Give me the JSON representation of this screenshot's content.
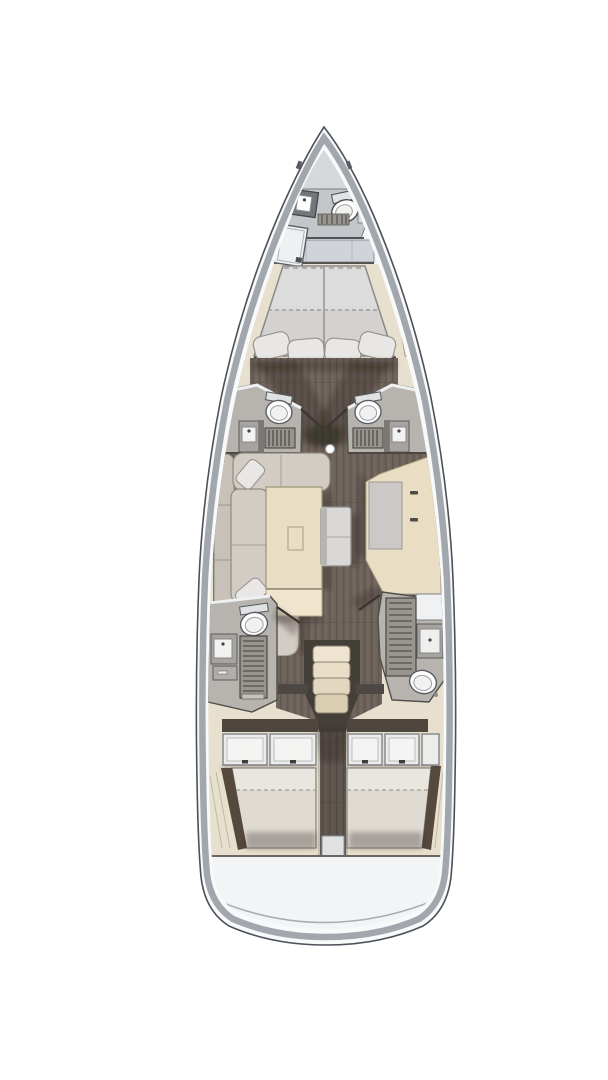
{
  "meta": {
    "type": "sailing-yacht-interior-floor-plan",
    "view": "top-down",
    "orientation": "bow-up",
    "canvas": {
      "width": 608,
      "height": 1080
    }
  },
  "palette": {
    "page_bg": "#ffffff",
    "hull_fill": "#f8f9fa",
    "hull_outline": "#4c5058",
    "hull_band": "#a2a7ae",
    "deck_white": "#f4f5f7",
    "anchor_locker": "#d6d9dc",
    "interior_beige": "#e8e0ce",
    "panel_beige": "#e5dcc8",
    "wood_floor": "#6d635b",
    "wood_line": "#5f564f",
    "head_floor": "#b7b4b0",
    "wall_dark": "#4b4844",
    "wall_white": "#eef0f1",
    "fixture_white": "#fdfdfd",
    "cabinet_gray": "#a6a3a0",
    "grate_gray": "#989591",
    "grate_slat": "#5f5c58",
    "mattress_light": "#dcdcdd",
    "mattress_mid": "#d3d2d0",
    "aft_mattress_top": "#e9e6df",
    "aft_mattress_bottom": "#dfdbd2",
    "pillow": "#e8e7e5",
    "sofa": "#d2ccc4",
    "sofa_back": "#c7c1ba",
    "table_beige": "#e9dec3",
    "table_edge": "#a2977b",
    "table_ext": "#efe5cd",
    "counter_gray": "#ccc8c6",
    "bench": "#dad8d6",
    "locker_panel": "#ececea",
    "locker_inner": "#f4f4f3",
    "step_1": "#eee4cf",
    "step_2": "#e8dec8",
    "step_3": "#e2d7bf",
    "step_4": "#d9cdb2",
    "stair_well": "#453f39",
    "bulkhead_brown": "#4f473e",
    "wardrobe_brown": "#55483d",
    "transom": "#f3f4f6",
    "shadow": "rgba(40,35,28,0.30)"
  },
  "regions": {
    "bow": [
      "anchor-locker",
      "forward-head",
      "forward-dresser",
      "forward-wardrobe"
    ],
    "forward_cabin": [
      "v-berth-double-bed",
      "side-shelf-port",
      "side-shelf-starboard",
      "pillows"
    ],
    "midship": [
      "port-mid-head",
      "starboard-mid-head",
      "corridor",
      "mast-post"
    ],
    "salon": [
      "c-shaped-sofa",
      "dining-table",
      "table-extension",
      "bench-seat",
      "galley-counter"
    ],
    "aft_midship": [
      "port-aft-head",
      "starboard-aft-head",
      "companionway-stairs"
    ],
    "aft": [
      "port-aft-cabin",
      "starboard-aft-cabin",
      "center-corridor",
      "transom"
    ]
  },
  "fixtures": {
    "toilets": 5,
    "sinks": 5,
    "shower_grates": 5,
    "double_beds": 3,
    "stair_steps": 4
  }
}
